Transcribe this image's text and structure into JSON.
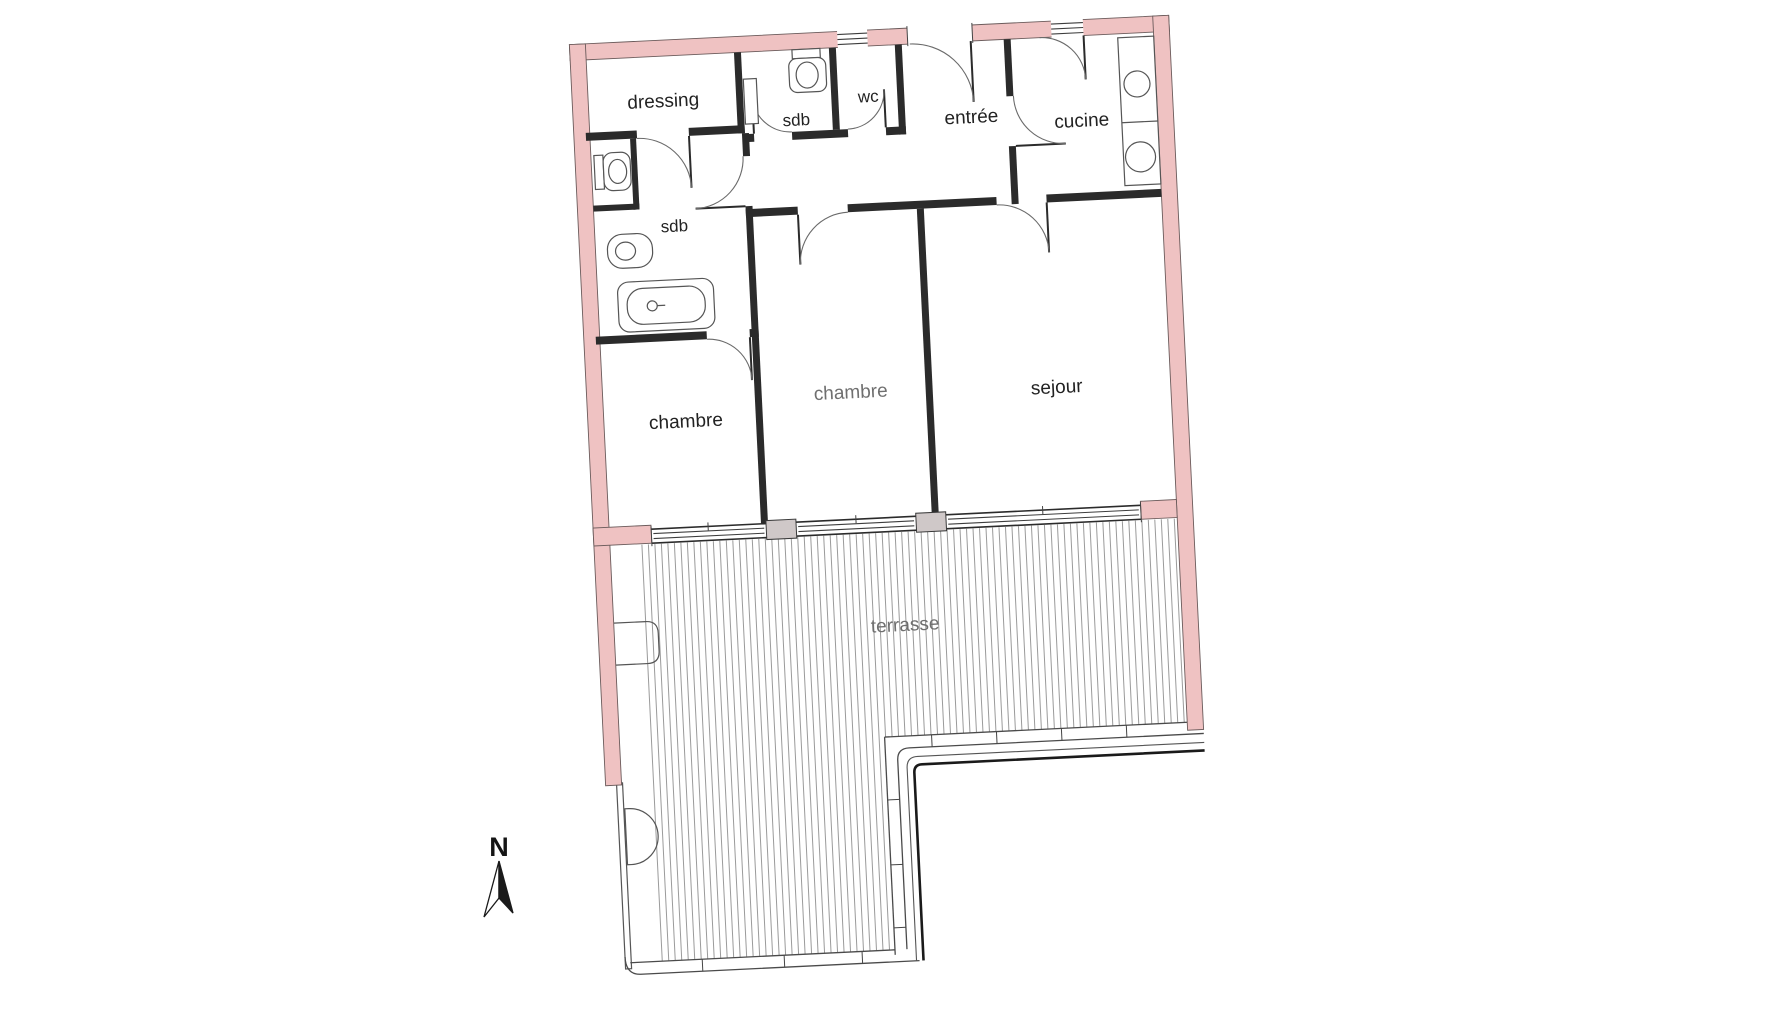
{
  "plan": {
    "rooms": [
      {
        "id": "dressing",
        "label": "dressing"
      },
      {
        "id": "sdb_top",
        "label": "sdb"
      },
      {
        "id": "wc",
        "label": "wc"
      },
      {
        "id": "entree",
        "label": "entrée"
      },
      {
        "id": "cucine",
        "label": "cucine"
      },
      {
        "id": "sdb_left",
        "label": "sdb"
      },
      {
        "id": "chambre_left",
        "label": "chambre"
      },
      {
        "id": "chambre_middle",
        "label": "chambre"
      },
      {
        "id": "sejour",
        "label": "sejour"
      },
      {
        "id": "terrasse",
        "label": "terrasse"
      }
    ],
    "compass": {
      "label": "N"
    },
    "icons": [
      "north-arrow-icon",
      "toilet-icon",
      "bathtub-icon",
      "washbasin-icon",
      "sink-icon",
      "hob-icon",
      "door-swing-icon",
      "window-icon"
    ],
    "colors": {
      "exterior_wall": "#efc2c2",
      "interior_wall": "#2b2b2b",
      "fixture_line": "#555555",
      "hatch_line": "#8f8f8f",
      "label_dark": "#222222",
      "label_muted": "#6f6f6f",
      "post_fill": "#cfc8c8"
    }
  }
}
